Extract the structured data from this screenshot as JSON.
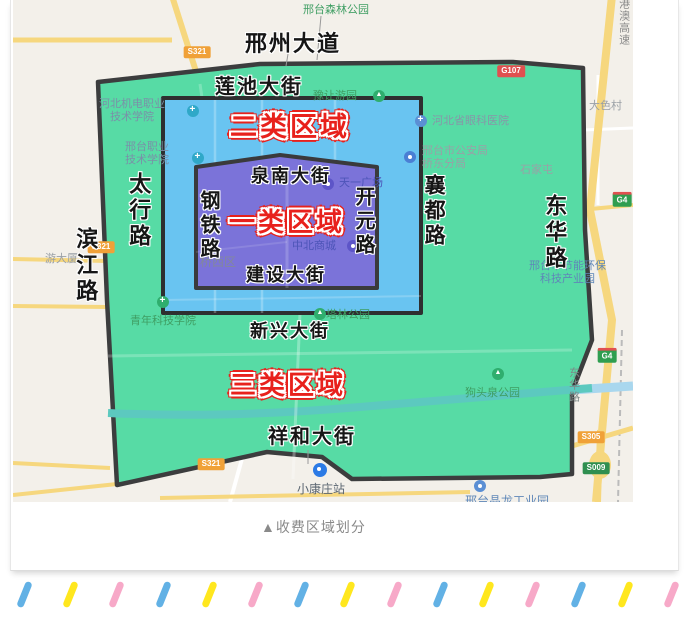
{
  "caption": "▲收费区域划分",
  "zones": {
    "one": {
      "label": "一类区域",
      "color": "#7b73d9"
    },
    "two": {
      "label": "二类区域",
      "color": "#69c4f1"
    },
    "three": {
      "label": "三类区域",
      "color": "#57dba5"
    },
    "border_color": "#3c3d3e",
    "label_color": "#e8211c"
  },
  "streets": {
    "xingzhou": "邢州大道",
    "lianchi": "莲池大街",
    "quannan": "泉南大街",
    "jianshe": "建设大街",
    "xinxing": "新兴大街",
    "xianghe": "祥和大街",
    "taihang": "太行路",
    "binjiang": "滨江路",
    "gangtie": "钢铁路",
    "kaiyuan": "开元路",
    "xiangdu": "襄都路",
    "donghua": "东华路"
  },
  "pois": {
    "senlin": "邢台森林公园",
    "yurang": "豫让游园",
    "yanke": "河北省眼科医院",
    "jidian": "河北机电职业\n技术学院",
    "xtzhiye": "邢台职业\n技术学院",
    "gongan": "邢台市公安局\n桥东分局",
    "shijiatun": "石家屯",
    "dasecun": "大色村",
    "qiaoxi": "桥西区",
    "zhongbei": "中北商城",
    "tianyi": "天一广场",
    "youdasha": "游大厦",
    "qingnian": "青年科技学院",
    "talin": "塔林公园",
    "goutou": "狗头泉公园",
    "jieneng": "邢台市节能环保\n科技产业园",
    "donghua_small": "东华路",
    "xiaokang": "小康庄站",
    "gongyeyuan": "邢台晶龙工业园",
    "gaosu": "京港澳高速"
  },
  "badges": {
    "s321": "S321",
    "g107": "G107",
    "g4": "G4",
    "s305": "S305",
    "s009": "S009"
  },
  "deco": {
    "pattern": [
      "#62b1e5",
      "#ffe71e",
      "#f7a9c8"
    ],
    "count": 15
  }
}
